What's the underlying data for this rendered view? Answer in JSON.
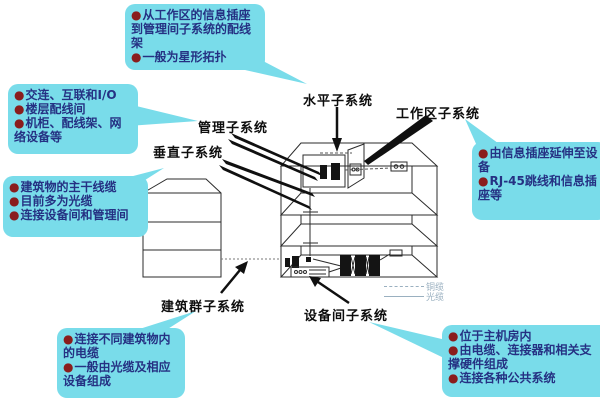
{
  "ui": {
    "bullet_char": "●"
  },
  "colors": {
    "callout_bg": "#79dcea",
    "callout_text": "#253183",
    "bullet": "#8a1d1d",
    "label_text": "#0d0d0d",
    "line_ink": "#2b2b2b",
    "legend_text": "#9ab0c0"
  },
  "labels": {
    "horizontal": "水平子系统",
    "work_area": "工作区子系统",
    "management": "管理子系统",
    "vertical": "垂直子系统",
    "campus": "建筑群子系统",
    "equipment_room": "设备间子系统"
  },
  "callouts": {
    "horizontal": {
      "items": [
        "从工作区的信息插座到管理间子系统的配线架",
        "一般为星形拓扑"
      ]
    },
    "management": {
      "items": [
        "交连、互联和I/O",
        "楼层配线间",
        "机柜、配线架、网络设备等"
      ]
    },
    "vertical": {
      "items": [
        "建筑物的主干线缆",
        "目前多为光缆",
        "连接设备间和管理间"
      ]
    },
    "campus": {
      "items": [
        "连接不同建筑物内的电缆",
        "一般由光缆及相应设备组成"
      ]
    },
    "work_area": {
      "items": [
        "由信息插座延伸至设备",
        "RJ-45跳线和信息插座等"
      ]
    },
    "equipment_room": {
      "items": [
        "位于主机房内",
        "由电缆、连接器和相关支撑硬件组成",
        "连接各种公共系统"
      ]
    }
  },
  "legend": {
    "copper": "铜缆",
    "fiber": "光缆"
  }
}
